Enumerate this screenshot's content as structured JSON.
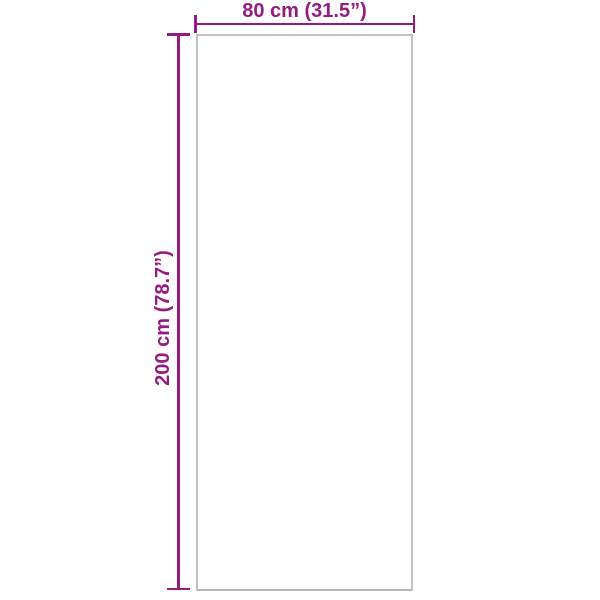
{
  "colors": {
    "accent": "#951B81",
    "outline": "#C1C1C1",
    "background": "#FFFFFF"
  },
  "diagram": {
    "width_label": "80 cm (31.5”)",
    "height_label": "200 cm (78.7”)"
  }
}
